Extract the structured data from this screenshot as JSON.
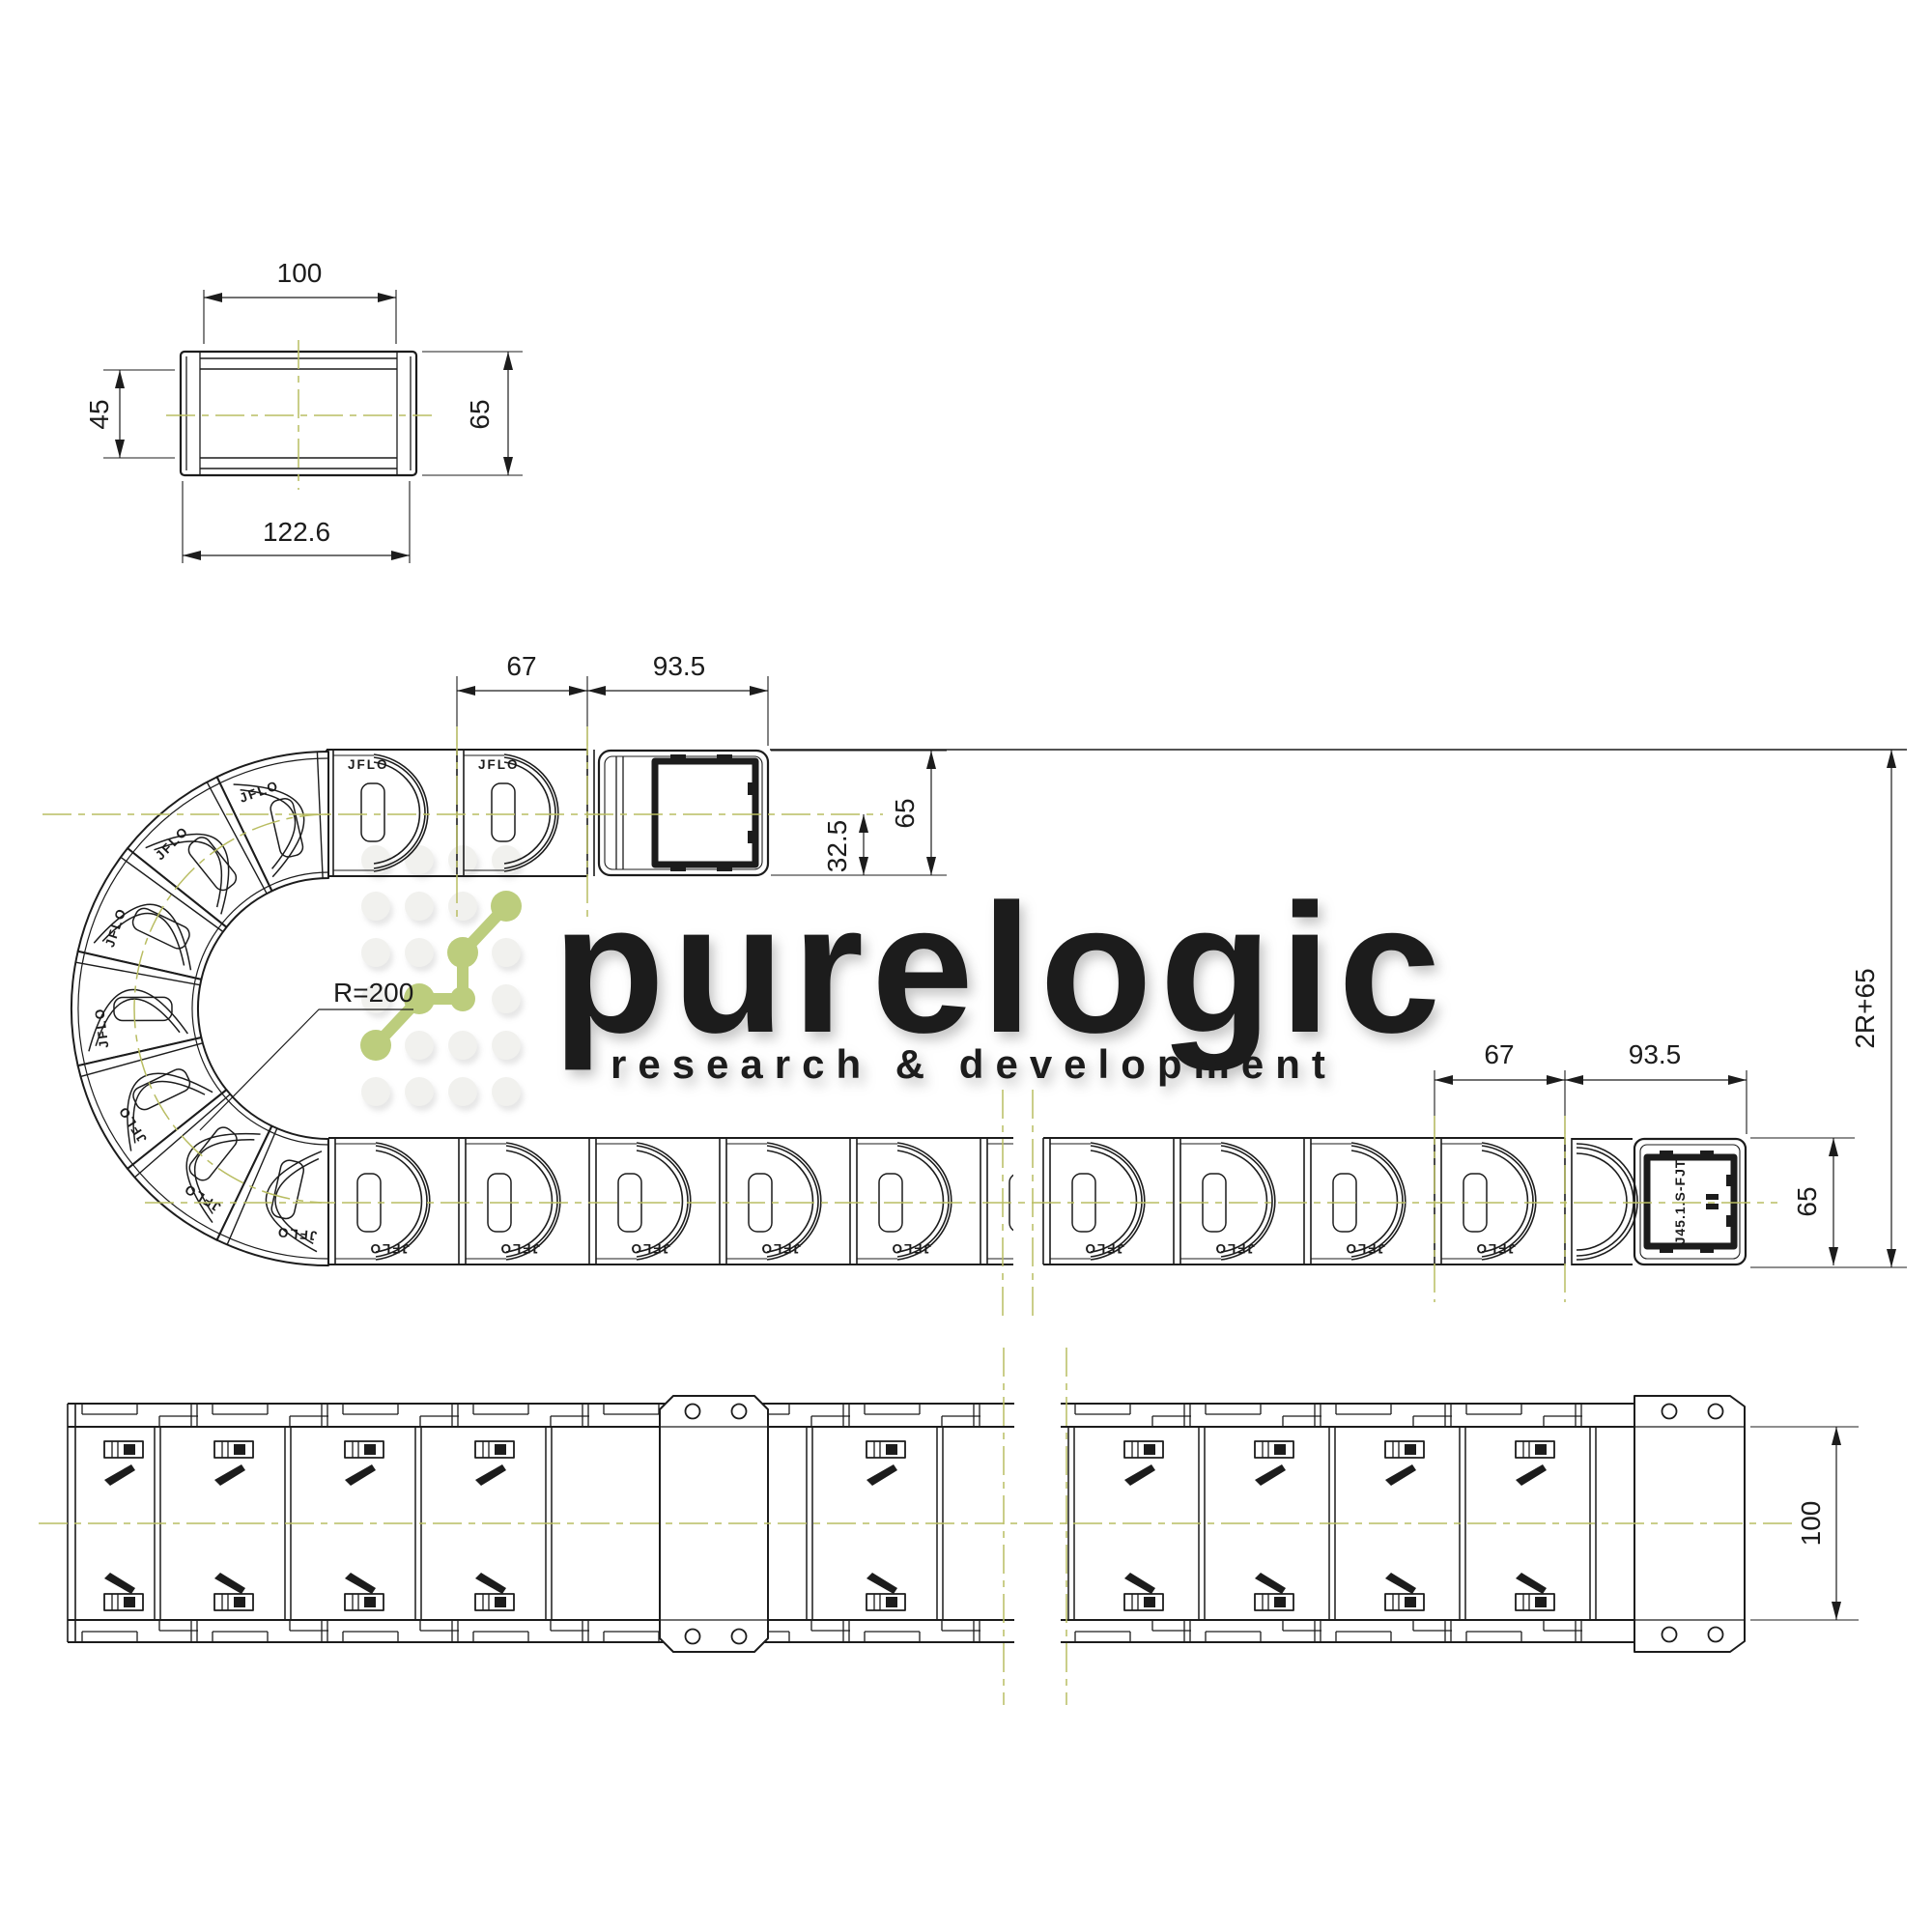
{
  "watermark": {
    "brand": "purelogic",
    "tagline": "research & development"
  },
  "labels": {
    "link_brand": "JFLO",
    "end_connector_model": "J45.1.S-FJT"
  },
  "dims": {
    "section_inner_width": "100",
    "section_inner_height": "45",
    "section_outer_height": "65",
    "section_outer_width": "122.6",
    "pitch": "67",
    "end_length": "93.5",
    "chain_height": "65",
    "half_height": "32.5",
    "bend_radius": "R=200",
    "overall_height": "2R+65",
    "pitch_lower": "67",
    "end_length_lower": "93.5",
    "chain_height_lower": "65",
    "top_inner_width": "100"
  },
  "colors": {
    "centerline": "#b9bd62",
    "logo_green": "#bccd7d",
    "ink": "#1c1c1c",
    "watermark_text": "#fdfdfd",
    "watermark_dot": "#f1f1ee"
  }
}
